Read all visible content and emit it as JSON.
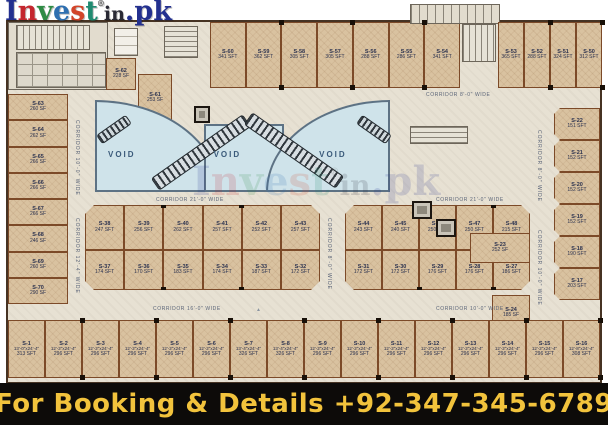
{
  "banner": {
    "text": "For Booking & Details +92-347-345-6789",
    "bg": "#0d0b09",
    "color": "#f2c33c"
  },
  "logo": {
    "letters": [
      {
        "ch": "I",
        "color": "#23308f"
      },
      {
        "ch": "n",
        "color": "#c4262e"
      },
      {
        "ch": "v",
        "color": "#2e8b44"
      },
      {
        "ch": "e",
        "color": "#2e6fb0"
      },
      {
        "ch": "s",
        "color": "#d2452a"
      },
      {
        "ch": "t",
        "color": "#1f8a70"
      },
      {
        "ch": "®",
        "color": "#555555",
        "cls": "reg"
      },
      {
        "ch": "i",
        "color": "#2a2a35",
        "cls": "small"
      },
      {
        "ch": "n",
        "color": "#2a2a35",
        "cls": "small"
      },
      {
        "ch": ".",
        "color": "#23308f"
      },
      {
        "ch": "p",
        "color": "#23308f"
      },
      {
        "ch": "k",
        "color": "#23308f"
      }
    ]
  },
  "icons": {
    "north_arrow": "▲"
  },
  "palette": {
    "shop_fill": "#d9c2a0",
    "shop_border": "#7c4a28",
    "corridor": "#e7e1d3",
    "void_fill": "#cfe3ea",
    "banner_bg": "#0d0b09",
    "banner_text": "#f2c33c"
  },
  "plan": {
    "voids": [
      {
        "label": "VOID"
      },
      {
        "label": "VOID"
      },
      {
        "label": "VOID"
      }
    ],
    "corridors": {
      "top_right_h": "CORRIDOR  8'-0\" WIDE",
      "left_v_upper": "CORRIDOR  10'-0\" WIDE",
      "left_v_lower": "CORRIDOR  12'-4\" WIDE",
      "void_bottom_left": "CORRIDOR  21'-0\" WIDE",
      "void_bottom_right": "CORRIDOR  21'-0\" WIDE",
      "mid_gap_v": "CORRIDOR  8'-0\" WIDE",
      "right_v_upper": "CORRIDOR  8'-0\" WIDE",
      "right_v_lower": "CORRIDOR  10'-0\" WIDE",
      "bottom_left_h": "CORRIDOR  16'-0\" WIDE",
      "bottom_right_h": "CORRIDOR  10'-0\" WIDE"
    },
    "top_left": {
      "s62": {
        "id": "S-62",
        "area": "228 SF"
      },
      "s61": {
        "id": "S-61",
        "area": "253 SF"
      }
    },
    "top_row_left": {
      "shops": [
        {
          "id": "S-60",
          "area": "341 SFT"
        },
        {
          "id": "S-59",
          "area": "362 SFT"
        },
        {
          "id": "S-58",
          "area": "305 SFT"
        },
        {
          "id": "S-57",
          "area": "305 SFT"
        },
        {
          "id": "S-56",
          "area": "288 SFT"
        },
        {
          "id": "S-55",
          "area": "286 SFT"
        },
        {
          "id": "S-54",
          "area": "341 SFT"
        }
      ]
    },
    "top_row_right": {
      "shops": [
        {
          "id": "S-53",
          "area": "365 SFT"
        },
        {
          "id": "S-52",
          "area": "288 SFT"
        },
        {
          "id": "S-51",
          "area": "324 SFT"
        },
        {
          "id": "S-50",
          "area": "312 SFT"
        }
      ]
    },
    "left_column": {
      "shops": [
        {
          "id": "S-63",
          "area": "260 SF"
        },
        {
          "id": "S-64",
          "area": "262 SF"
        },
        {
          "id": "S-65",
          "area": "266 SF"
        },
        {
          "id": "S-66",
          "area": "266 SF"
        },
        {
          "id": "S-67",
          "area": "266 SF"
        },
        {
          "id": "S-68",
          "area": "246 SF"
        },
        {
          "id": "S-69",
          "area": "260 SF"
        },
        {
          "id": "S-70",
          "area": "290 SF"
        }
      ]
    },
    "middle_upper_left": {
      "shops": [
        {
          "id": "S-38",
          "area": "247 SFT"
        },
        {
          "id": "S-39",
          "area": "256 SFT"
        },
        {
          "id": "S-40",
          "area": "262 SFT"
        },
        {
          "id": "S-41",
          "area": "257 SFT"
        },
        {
          "id": "S-42",
          "area": "252 SFT"
        },
        {
          "id": "S-43",
          "area": "257 SFT"
        }
      ]
    },
    "middle_lower_left": {
      "shops": [
        {
          "id": "S-37",
          "area": "174 SFT"
        },
        {
          "id": "S-36",
          "area": "170 SFT"
        },
        {
          "id": "S-35",
          "area": "183 SFT"
        },
        {
          "id": "S-34",
          "area": "174 SFT"
        },
        {
          "id": "S-33",
          "area": "187 SFT"
        },
        {
          "id": "S-32",
          "area": "172 SFT"
        }
      ]
    },
    "middle_upper_right": {
      "shops": [
        {
          "id": "S-44",
          "area": "243 SFT"
        },
        {
          "id": "S-45",
          "area": "240 SFT"
        },
        {
          "id": "S-46",
          "area": "250 SFT"
        },
        {
          "id": "S-47",
          "area": "250 SFT"
        },
        {
          "id": "S-48",
          "area": "215 SFT"
        }
      ]
    },
    "middle_lower_right": {
      "shops": [
        {
          "id": "S-31",
          "area": "172 SFT"
        },
        {
          "id": "S-30",
          "area": "172 SFT"
        },
        {
          "id": "S-29",
          "area": "176 SFT"
        },
        {
          "id": "S-28",
          "area": "176 SFT"
        },
        {
          "id": "S-27",
          "area": "186 SFT"
        }
      ]
    },
    "right_block": {
      "s23": {
        "id": "S-23",
        "area": "252 SF"
      },
      "s24": {
        "id": "S-24",
        "area": "185 SF"
      },
      "s49": {
        "id": "S-49",
        "area": "272 SF"
      },
      "s25": {
        "id": "S-25",
        "area": "243 SF"
      }
    },
    "right_column": {
      "shops": [
        {
          "id": "S-22",
          "area": "151 SFT"
        },
        {
          "id": "S-21",
          "area": "152 SFT"
        },
        {
          "id": "S-20",
          "area": "152 SFT"
        },
        {
          "id": "S-19",
          "area": "152 SFT"
        },
        {
          "id": "S-18",
          "area": "190 SFT"
        },
        {
          "id": "S-17",
          "area": "203 SFT"
        }
      ]
    },
    "bottom_row": {
      "shops": [
        {
          "id": "S-1",
          "dims": "13'-0\"x24'-4\"",
          "area": "313 SFT"
        },
        {
          "id": "S-2",
          "dims": "12'-2\"x24'-4\"",
          "area": "296 SFT"
        },
        {
          "id": "S-3",
          "dims": "12'-2\"x24'-4\"",
          "area": "296 SFT"
        },
        {
          "id": "S-4",
          "dims": "12'-2\"x24'-4\"",
          "area": "296 SFT"
        },
        {
          "id": "S-5",
          "dims": "12'-2\"x24'-4\"",
          "area": "296 SFT"
        },
        {
          "id": "S-6",
          "dims": "12'-2\"x24'-4\"",
          "area": "296 SFT"
        },
        {
          "id": "S-7",
          "dims": "13'-4\"x24'-4\"",
          "area": "326 SFT"
        },
        {
          "id": "S-8",
          "dims": "13'-4\"x24'-4\"",
          "area": "326 SFT"
        },
        {
          "id": "S-9",
          "dims": "12'-2\"x24'-4\"",
          "area": "296 SFT"
        },
        {
          "id": "S-10",
          "dims": "12'-2\"x24'-4\"",
          "area": "296 SFT"
        },
        {
          "id": "S-11",
          "dims": "12'-2\"x24'-4\"",
          "area": "296 SFT"
        },
        {
          "id": "S-12",
          "dims": "12'-2\"x24'-4\"",
          "area": "296 SFT"
        },
        {
          "id": "S-13",
          "dims": "12'-2\"x24'-4\"",
          "area": "296 SFT"
        },
        {
          "id": "S-14",
          "dims": "12'-2\"x24'-4\"",
          "area": "296 SFT"
        },
        {
          "id": "S-15",
          "dims": "12'-2\"x24'-4\"",
          "area": "296 SFT"
        },
        {
          "id": "S-16",
          "dims": "12'-8\"x24'-4\"",
          "area": "308 SFT"
        }
      ]
    }
  }
}
